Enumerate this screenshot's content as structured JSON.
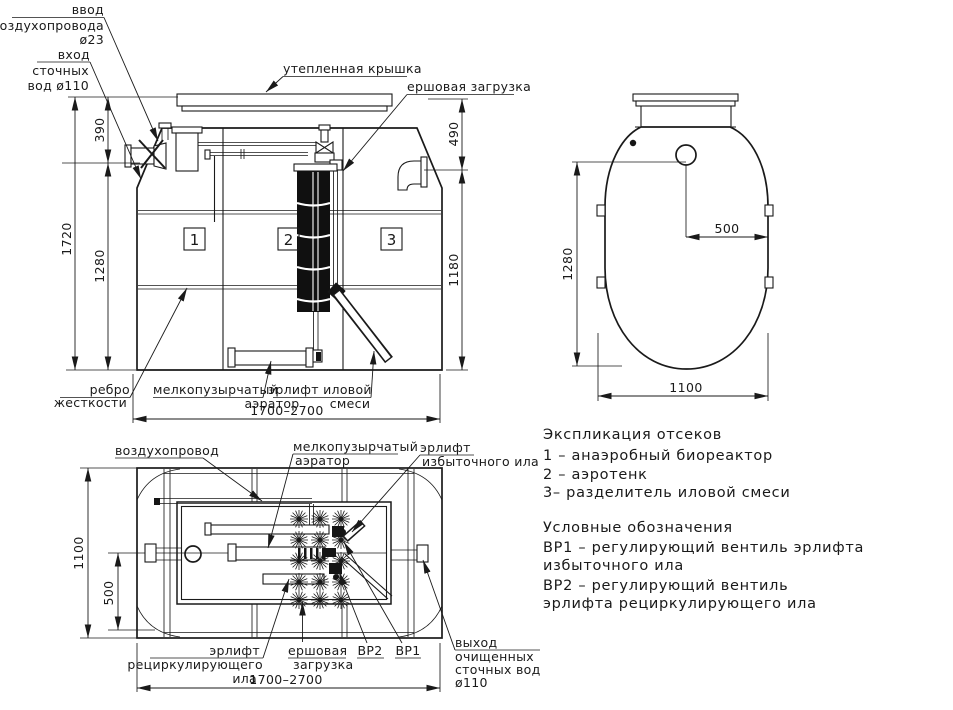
{
  "front": {
    "lbl_air_inlet": [
      "ввод",
      "воздухопровода",
      "ø23"
    ],
    "lbl_sewage_inlet": [
      "вход",
      "сточных",
      "вод ø110"
    ],
    "lbl_lid": "утепленная крышка",
    "lbl_brush": "ершовая загрузка",
    "lbl_rib": [
      "ребро",
      "жесткости"
    ],
    "lbl_aerator": [
      "мелкопузырчатый",
      "аэратор"
    ],
    "lbl_airlift": [
      "эрлифт иловой",
      "смеси"
    ],
    "dim_1720": "1720",
    "dim_390": "390",
    "dim_1280": "1280",
    "dim_490": "490",
    "dim_1180": "1180",
    "dim_width": "1700–2700",
    "comp": [
      "1",
      "2",
      "3"
    ]
  },
  "side": {
    "dim_1280": "1280",
    "dim_500": "500",
    "dim_1100": "1100"
  },
  "plan": {
    "lbl_airduct": "воздухопровод",
    "lbl_aerator": [
      "мелкопузырчатый",
      "аэратор"
    ],
    "lbl_excess": [
      "эрлифт",
      "избыточного ила"
    ],
    "lbl_recirc": [
      "эрлифт",
      "рециркулирующего",
      "ила"
    ],
    "lbl_brush": [
      "ершовая",
      "загрузка"
    ],
    "lbl_vr2": "ВР2",
    "lbl_vr1": "ВР1",
    "lbl_outlet": [
      "выход",
      "очищенных",
      "сточных вод",
      "ø110"
    ],
    "dim_1100": "1100",
    "dim_500": "500",
    "dim_length": "1700–2700"
  },
  "legend": {
    "title": "Экспликация отсеков",
    "item1": "1 –  анаэробный биореактор",
    "item2": "2 –  аэротенк",
    "item3": "3–  разделитель иловой смеси",
    "sym_title": "Условные обозначения",
    "sym1a": "ВР1 –  регулирующий вентиль эрлифта",
    "sym1b": "избыточного ила",
    "sym2a": "ВР2 –  регулирующий вентиль",
    "sym2b": "эрлифта рециркулирующего ила"
  },
  "colors": {
    "ink": "#1a1a1a",
    "paper": "#ffffff"
  }
}
